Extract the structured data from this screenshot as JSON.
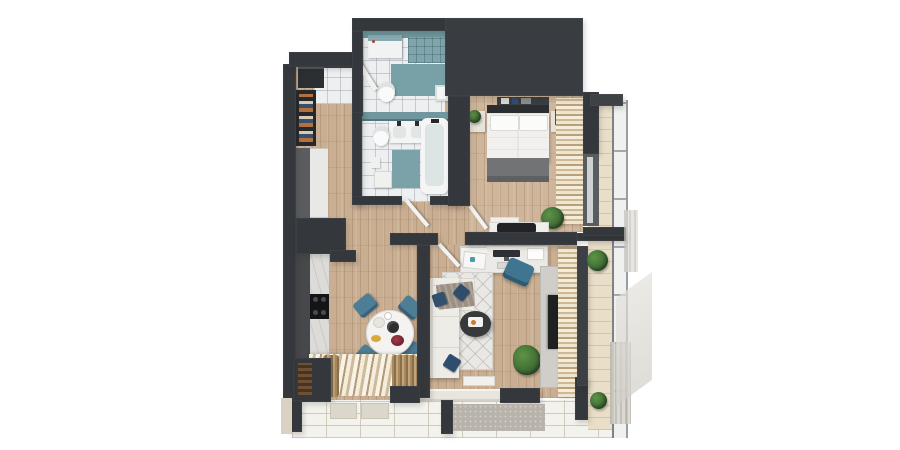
{
  "scene": {
    "title": "3d-apartment-floor-plan-render",
    "view": "top-down",
    "background": "#ffffff"
  },
  "rooms": [
    {
      "name": "entry-hall"
    },
    {
      "name": "laundry-wc"
    },
    {
      "name": "bathroom"
    },
    {
      "name": "bedroom"
    },
    {
      "name": "hallway"
    },
    {
      "name": "kitchen"
    },
    {
      "name": "dining-area"
    },
    {
      "name": "living-room"
    },
    {
      "name": "workspace"
    },
    {
      "name": "balcony"
    },
    {
      "name": "terrace"
    }
  ],
  "furniture": {
    "entry_hall": [
      "entry-mat",
      "entry-door",
      "shoe-cabinet",
      "open-wardrobe",
      "hall-cabinet"
    ],
    "laundry_wc": [
      "washing-machine",
      "toilet",
      "small-sink",
      "teal-bath-mat",
      "teal-tile-wall"
    ],
    "bathroom": [
      "double-sink-vanity",
      "bathtub",
      "toilet",
      "bath-cabinet",
      "teal-bath-mat",
      "bathroom-door"
    ],
    "bedroom": [
      "double-bed",
      "pillows",
      "gray-blanket",
      "headboard-shelf",
      "nightstand-left",
      "nightstand-right",
      "potted-plant",
      "beige-curtains",
      "console-table",
      "black-bag",
      "bedside-mat"
    ],
    "workspace": [
      "desk",
      "laptop",
      "monitor",
      "keyboard",
      "drawer-unit",
      "desk-chair",
      "papers"
    ],
    "living_room": [
      "l-shaped-sofa",
      "navy-pillows",
      "throw-blanket",
      "geometric-rug",
      "round-coffee-table",
      "tv-cabinet",
      "tv",
      "potted-plant",
      "beige-curtains",
      "white-doormat"
    ],
    "dining_area": [
      "round-dining-table",
      "dining-chair-1",
      "dining-chair-2",
      "dining-chair-3",
      "dining-chair-4",
      "coffee-pot",
      "plates",
      "flowers",
      "window-curtains"
    ],
    "kitchen": [
      "counter-dark",
      "counter-marble",
      "cooktop",
      "wood-log-storage"
    ],
    "balcony": [
      "glass-railing",
      "tile-floor",
      "potted-plant-1",
      "potted-plant-2",
      "hedge-screen",
      "overhang"
    ],
    "terrace": [
      "tile-floor",
      "door-mats",
      "gray-mat",
      "pillars"
    ]
  },
  "palette": {
    "wall": "#34373b",
    "wood_floor": "#c9ae92",
    "tile_floor": "#edeff1",
    "teal_tile": "#7fa6ac",
    "curtain_beige": "#cdb997",
    "sofa_white": "#edece7",
    "pillow_navy": "#2f4e6e",
    "chair_teal": "#4e7e95",
    "rug": "#e9e8e4",
    "balcony_tile": "#e9dfc8",
    "terrace_tile": "#f4f2ec",
    "plant_green": "#4a7d3c",
    "bed_linen": "#f1f0ee",
    "blanket_gray": "#717375",
    "tv_black": "#1e2022"
  }
}
